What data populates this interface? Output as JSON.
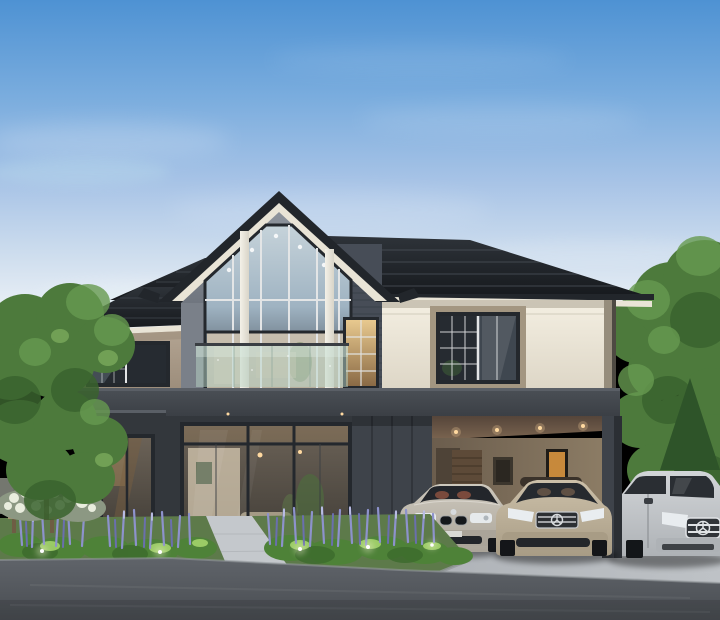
{
  "meta": {
    "type": "3d-architectural-rendering",
    "subject": "Modern two-storey luxury house with gabled glass facade, glass balcony, carport with three parked cars (BMW sedan, Mercedes sedan, Mercedes SUV), landscaped garden with purple flower spikes and garden lights, evening sky",
    "width": 720,
    "height": 620
  },
  "scene": {
    "sky": {
      "top": "#4e92d3",
      "upper": "#7badde",
      "mid": "#a7c3e6",
      "low": "#cfdeee",
      "horizon": "#ecf1f7",
      "cloud": "#ffffff",
      "cloud_cyan": "#cdeef0"
    },
    "house": {
      "roof_dark": "#22262b",
      "roof_face": "#2e3339",
      "roof_deep": "#16191d",
      "roof_streak": "#4a5058",
      "fascia_cream": "#e9e4d6",
      "gable_wall": "#8d939c",
      "gable_wall_shade": "#70767f",
      "gable_wall_dark": "#7a8089",
      "brick": "#474d57",
      "brick_line": "#363c45",
      "cream": "#f4efe2",
      "cream_shade": "#ddd6c6",
      "cream_shadow": "#b0a898",
      "taupe": "#b3a492",
      "taupe_shade": "#9c8d7b",
      "trim_taupe": "#a39681",
      "corner_trim": "#968d7c",
      "corner_dark": "#4e4a43",
      "band": "#4b5056",
      "band_deep": "#3a3e44",
      "band_lip": "#5a5f66",
      "wall_dark": "#33373c",
      "wall_deep": "#2b2f34",
      "panel": "#3e434a",
      "panel_line": "#31353b",
      "frame": "#24282d",
      "mullion": "#e3e5e6",
      "glass": "#262b31",
      "glass_mid": "#3f4750",
      "glass_sky": "#9fb3c2",
      "glass_sky_light": "#c6d3da",
      "glass_warm": "#d3c7b2",
      "interior_wall": "#d7c9b2",
      "interior_warm": "#c59a5e",
      "light_warm": "#ffd9a0",
      "art_glow": "#d9963f",
      "post": "#f4f1e8",
      "post_shade": "#d8d4c8",
      "balcony_glass": "#b7d3c5",
      "balcony_sheen": "#dfeee6",
      "rail": "#3a3e43",
      "carport_ceiling": "#7b6550",
      "carport_ceiling_deep": "#55453a",
      "carport_wall": "#8f7f67",
      "carport_wall_deep": "#6b5d4d",
      "carport_door": "#5d4a38",
      "carport_door_line": "#4a3a2b",
      "carport_floor": "#a39d92",
      "door_dark": "#4e4337",
      "seat_leather": "#8a5140"
    },
    "landscape": {
      "tree": "#4d7a3c",
      "tree_dark": "#3a632e",
      "tree_light": "#679a50",
      "tree_rim": "#8fbf6a",
      "conifer": "#2e5429",
      "trunk": "#5c4c3a",
      "lawn": "#5d7a4a",
      "shrub": "#4e8238",
      "shrub_dark": "#3c6a2c",
      "shrub_bright": "#a8d86e",
      "flower_purple": "#8d92cc",
      "flower_purple_deep": "#6a6fae",
      "flower_tip": "#c3c6ea",
      "flower_white": "#e9edde",
      "hedge_base": "#8c9883",
      "fence": "#74776f",
      "bench": "#a5906f",
      "bench_dark": "#6e5d44",
      "pavement": "#b7bbc0",
      "walkway": "#c4c8cc",
      "driveway_light": "#bec2c6",
      "driveway": "#aaaeb3",
      "curb": "#93979b",
      "road": "#60646a",
      "road_deep": "#494d52",
      "light_glow": "#f7f3d8"
    },
    "cars": [
      {
        "name": "bmw-sedan",
        "position": "carport-left",
        "body": "#cdc8bd",
        "body_shade": "#aaa499",
        "glass": "#23262b",
        "chrome": "#d6dadd"
      },
      {
        "name": "mercedes-sedan",
        "position": "carport-middle",
        "body": "#ccc0a9",
        "body_shade": "#a89c85",
        "glass": "#262a2f",
        "chrome": "#c6c9cd"
      },
      {
        "name": "mercedes-suv",
        "position": "right-of-post",
        "body": "#d2d5d8",
        "body_shade": "#aeb2b6",
        "glass": "#2a2e33",
        "chrome": "#dfe2e5"
      }
    ]
  }
}
